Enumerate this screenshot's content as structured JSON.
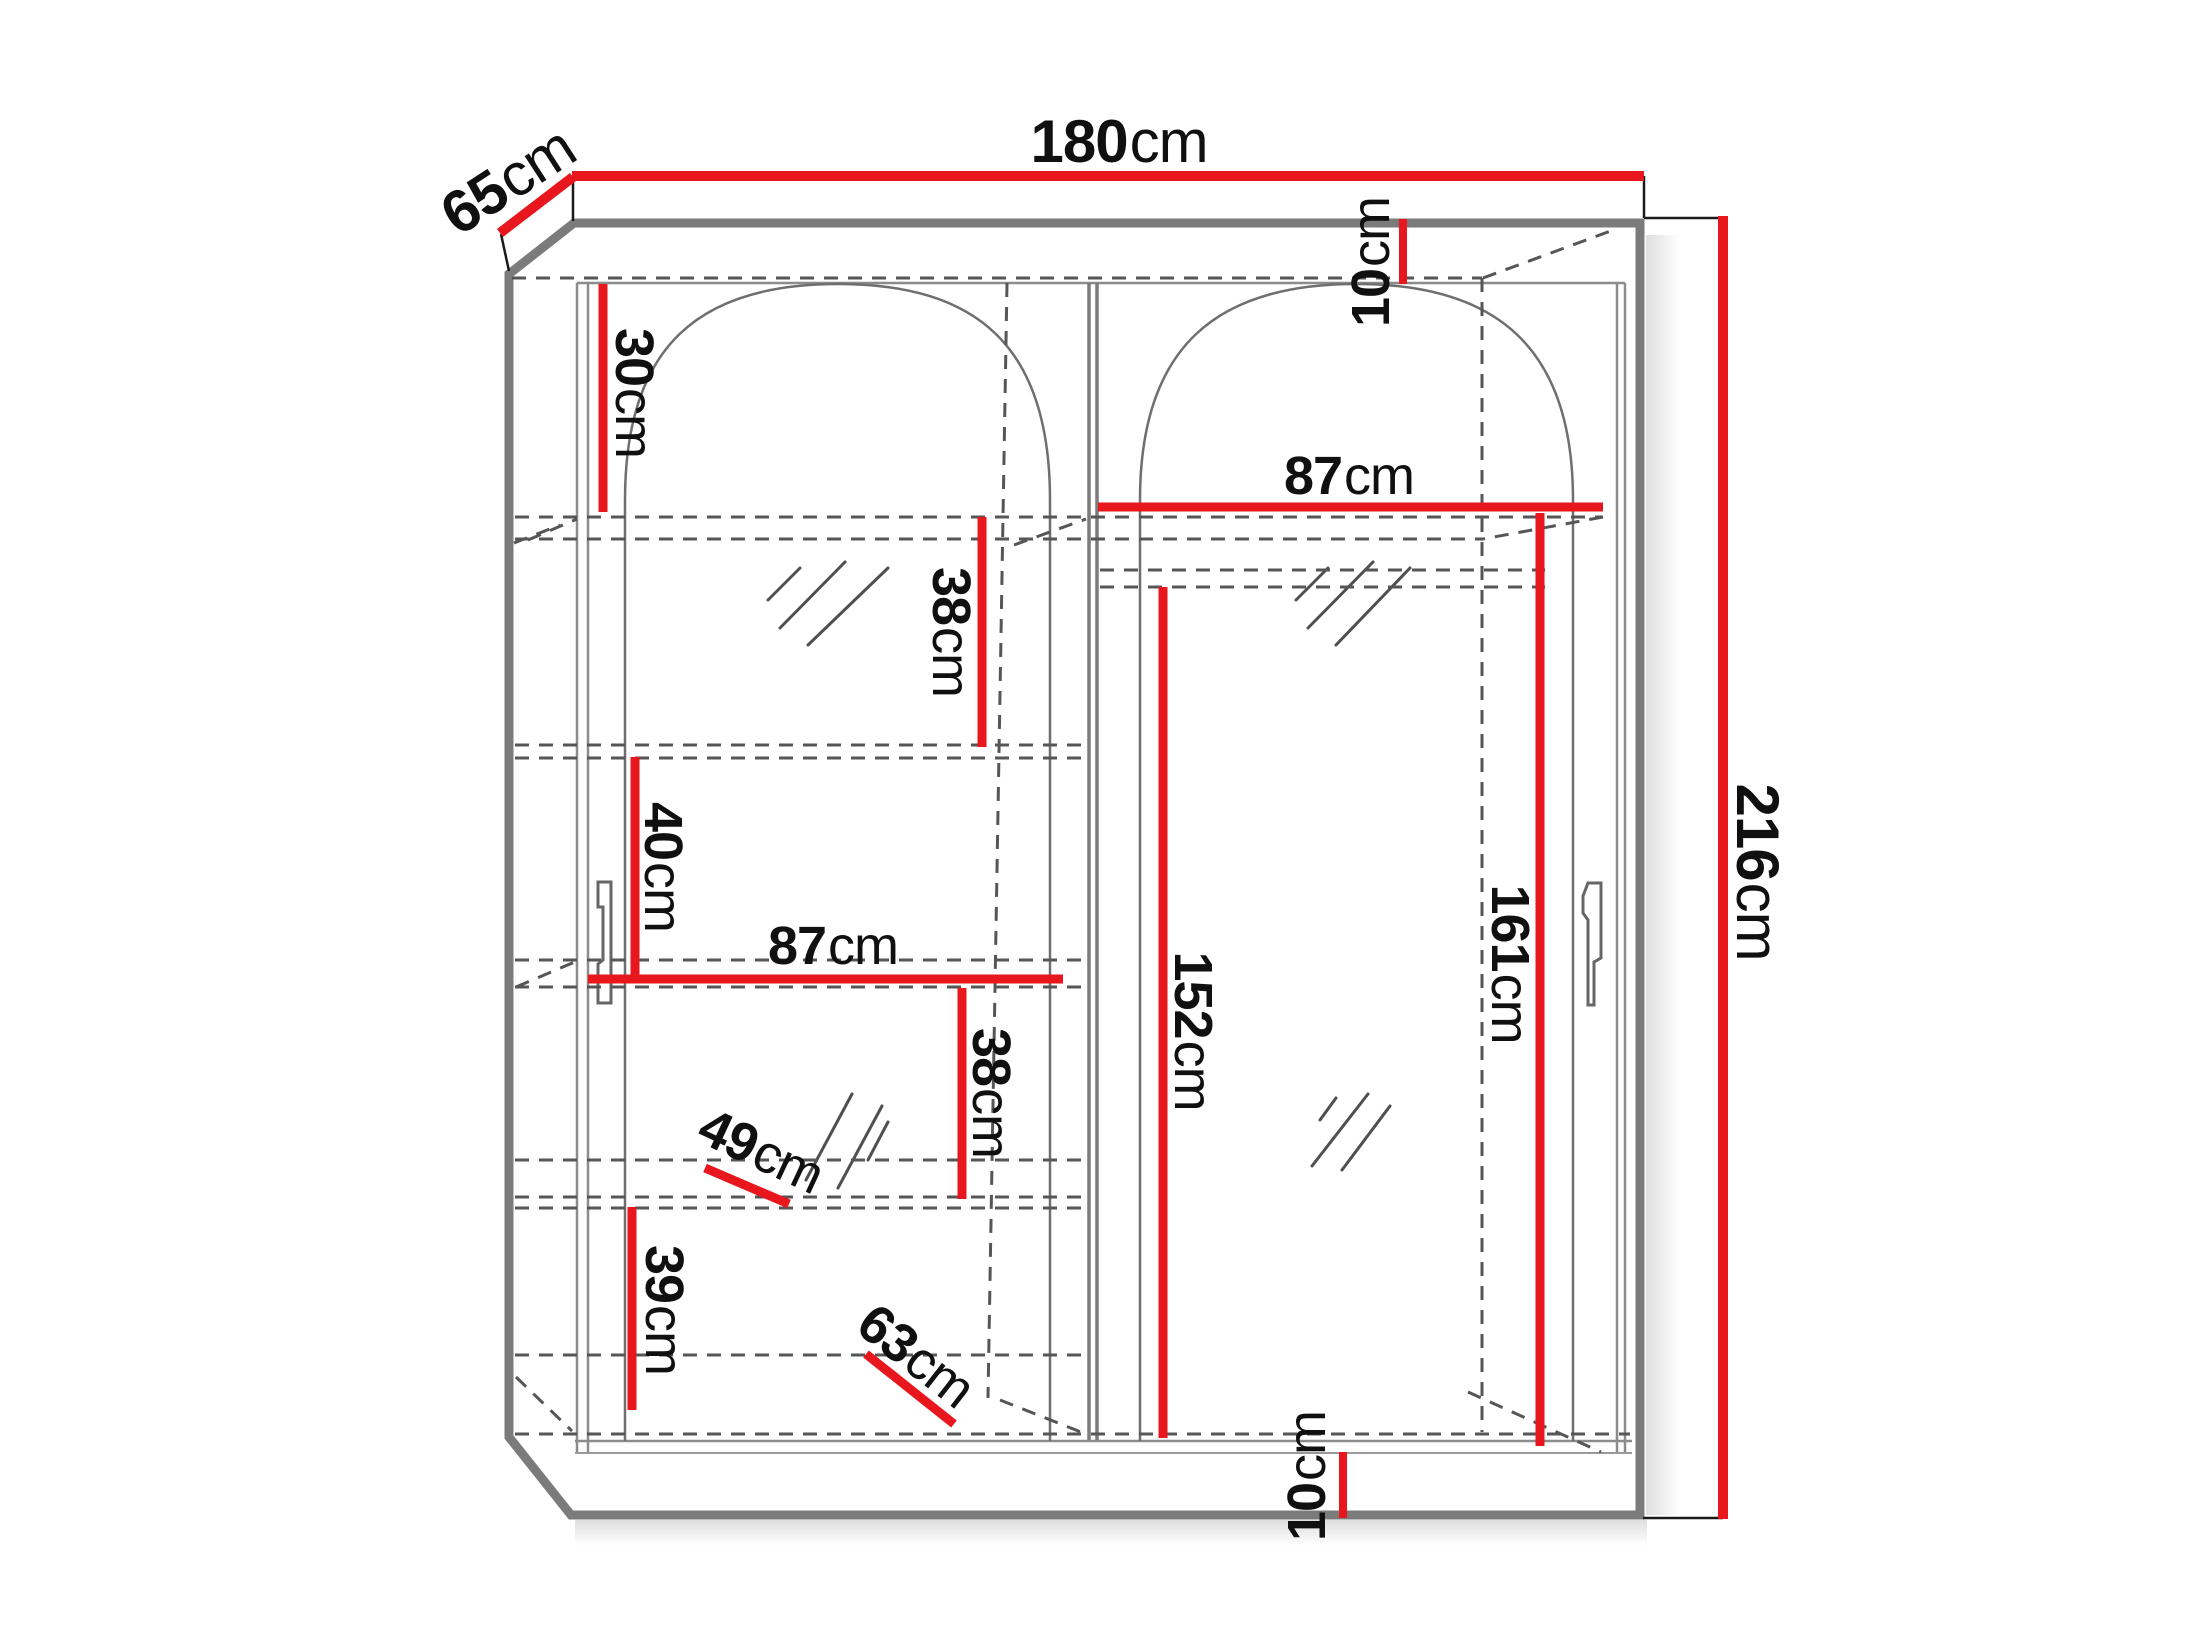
{
  "diagram": {
    "type": "furniture-dimension-drawing",
    "subject": "two-door sliding wardrobe with arched mirror doors",
    "unit": "cm"
  },
  "colors": {
    "dimension_line": "#e8161d",
    "outline_gray": "#7b7b7b",
    "hidden_line_gray": "#565656",
    "text": "#101010",
    "background": "#ffffff"
  },
  "dimensions": {
    "width_top": {
      "num": "180",
      "unit": "cm"
    },
    "depth": {
      "num": "65",
      "unit": "cm"
    },
    "height": {
      "num": "216",
      "unit": "cm"
    },
    "top_offset": {
      "num": "10",
      "unit": "cm"
    },
    "upper_left_gap": {
      "num": "30",
      "unit": "cm"
    },
    "right_inner_width": {
      "num": "87",
      "unit": "cm"
    },
    "left_shelf_gap_upper": {
      "num": "38",
      "unit": "cm"
    },
    "left_mid_gap": {
      "num": "40",
      "unit": "cm"
    },
    "left_inner_width": {
      "num": "87",
      "unit": "cm"
    },
    "left_shelf_gap_lower": {
      "num": "38",
      "unit": "cm"
    },
    "shelf_depth": {
      "num": "49",
      "unit": "cm"
    },
    "lower_left_gap": {
      "num": "39",
      "unit": "cm"
    },
    "bottom_shelf_width": {
      "num": "63",
      "unit": "cm"
    },
    "center_hang_height": {
      "num": "152",
      "unit": "cm"
    },
    "right_hang_height": {
      "num": "161",
      "unit": "cm"
    },
    "plinth_height": {
      "num": "10",
      "unit": "cm"
    }
  }
}
